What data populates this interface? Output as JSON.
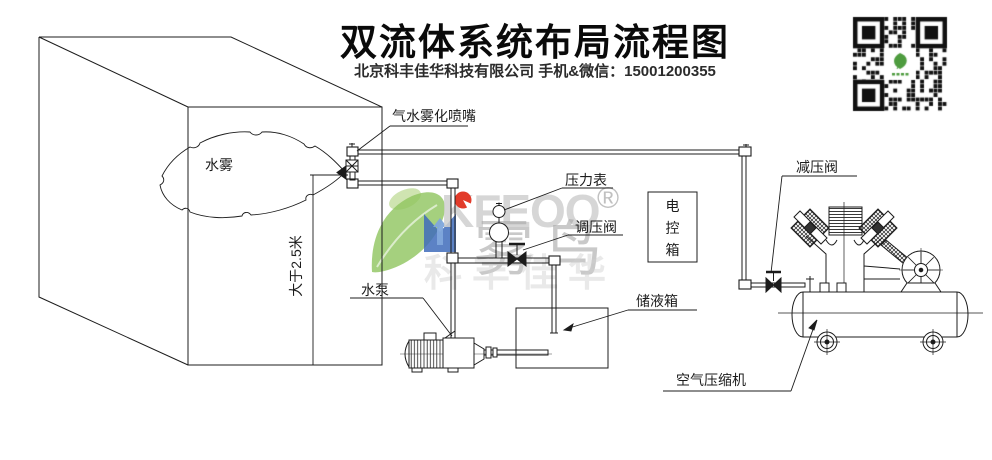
{
  "header": {
    "title": "双流体系统布局流程图",
    "subtitle": "北京科丰佳华科技有限公司 手机&微信：15001200355"
  },
  "labels": {
    "nozzle": "气水雾化喷嘴",
    "water_mist": "水雾",
    "dimension": "大于2.5米",
    "pressure_gauge": "压力表",
    "regulating_valve": "调压阀",
    "control_box": "电控箱",
    "reducing_valve": "减压阀",
    "water_pump": "水泵",
    "storage_tank": "储液箱",
    "air_compressor": "空气压缩机"
  },
  "watermark": {
    "brand_latin": "KFEOO",
    "brand_cn": "雾鸟",
    "registered_mark": "®",
    "company_short": "科丰佳华"
  },
  "colors": {
    "line": "#1c1c1c",
    "label": "#1c1c1c",
    "title": "#0a0a0a",
    "watermark_green": "#8fc45e",
    "watermark_green_light": "#c3dd9d",
    "watermark_blue": "#3f6cbb",
    "watermark_blue_light": "#7fa6dc",
    "watermark_gray": "#a6a6a6",
    "watermark_gray_light": "#d0d0d0",
    "watermark_red": "#e23b2a",
    "qr_green": "#4e9c3f"
  }
}
